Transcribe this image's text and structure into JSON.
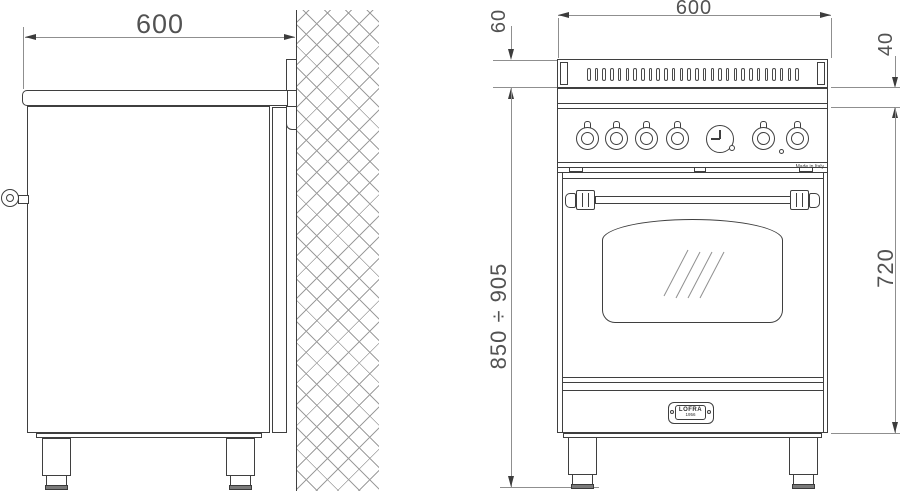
{
  "drawing": {
    "type": "appliance installation diagram",
    "subject": "60 cm range cooker, side and front elevation"
  },
  "dimensions": {
    "side_depth": "600",
    "front_width": "600",
    "backguard_height": "60",
    "trim_height": "40",
    "overall_height": "850 ÷ 905",
    "body_height": "720"
  },
  "badge": {
    "brand": "LOFRA",
    "year": "1956"
  },
  "labels": {
    "made_in": "Made in Italy"
  },
  "front_view": {
    "vent_slot_count": 28,
    "knob_count": 6,
    "has_timer_clock": true,
    "has_indicator_light": true,
    "reflection_line_count": 4
  },
  "colors": {
    "line": "#3f3f3f",
    "dim_line": "#8f8f8f",
    "dim_text": "#525252",
    "hatch": "#9d9d9d",
    "foot_pad": "#7a7a7a",
    "background": "#ffffff"
  }
}
